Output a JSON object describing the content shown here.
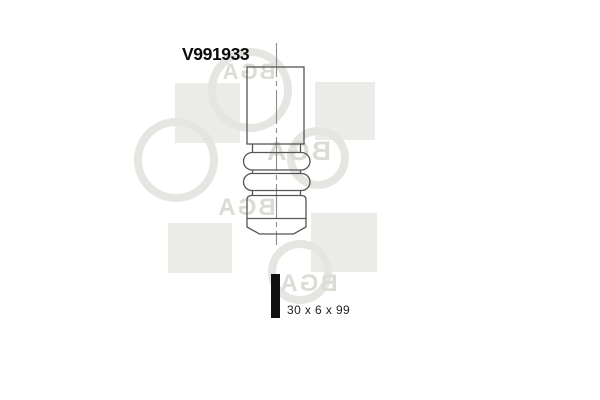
{
  "product": {
    "part_number": "V991933",
    "dimensions_label": "30 x 6 x 99"
  },
  "watermark": {
    "brand": "BGA"
  },
  "drawing": {
    "subject": "engine-valve-technical-line-drawing"
  },
  "colors": {
    "background": "#ffffff",
    "drawing_line": "#555555",
    "centerline": "#8c8c8c",
    "part_number_text": "#0a0a0a",
    "dimensions_text": "#222222",
    "dimension_bar": "#101010",
    "watermark_square": "#ebebe8",
    "watermark_ring": "#e5e5e1",
    "watermark_letters": "#dcdcd6"
  }
}
